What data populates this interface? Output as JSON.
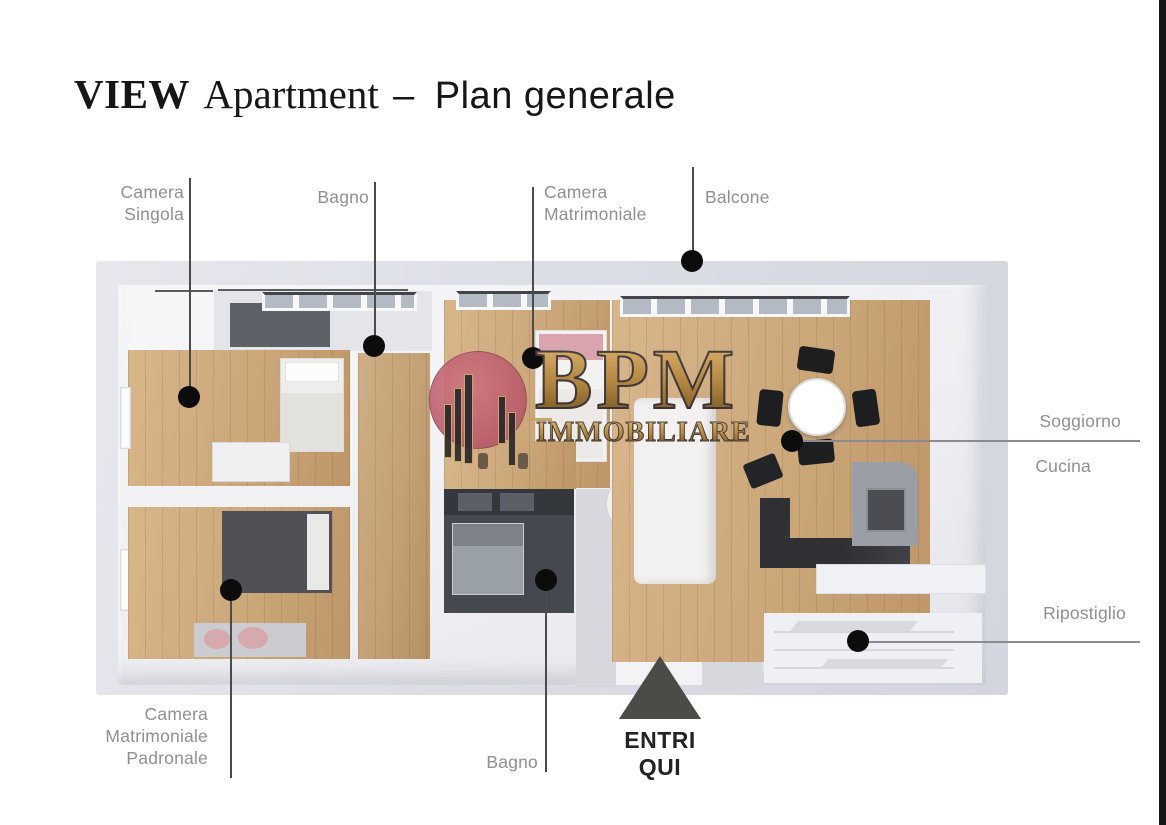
{
  "title": {
    "brand": "VIEW",
    "app": "Apartment",
    "dash": "–",
    "subtitle": "Plan generale"
  },
  "watermark": {
    "acronym": "BPM",
    "word": "IMMOBILIARE"
  },
  "entry_marker": {
    "line1": "ENTRI",
    "line2": "QUI"
  },
  "room_labels": {
    "camera_singola": {
      "line1": "Camera",
      "line2": "Singola"
    },
    "bagno_top": {
      "text": "Bagno"
    },
    "camera_matrimoniale": {
      "line1": "Camera",
      "line2": "Matrimoniale"
    },
    "balcone": {
      "text": "Balcone"
    },
    "soggiorno": {
      "text": "Soggiorno"
    },
    "cucina": {
      "text": "Cucina"
    },
    "ripostiglio": {
      "text": "Ripostiglio"
    },
    "camera_matrimoniale_padronale": {
      "line1": "Camera",
      "line2": "Matrimoniale",
      "line3": "Padronale"
    },
    "bagno_bottom": {
      "text": "Bagno"
    }
  },
  "colors": {
    "accent_pink": "#c0616f",
    "logo_gold": "#b8904f",
    "marker_dot": "#0c0c0c",
    "entry_triangle": "#4b4b47",
    "plan_mat": "#dcdee6",
    "wood_floor": "#cba97d",
    "leader_line": "#4a4b4f"
  }
}
